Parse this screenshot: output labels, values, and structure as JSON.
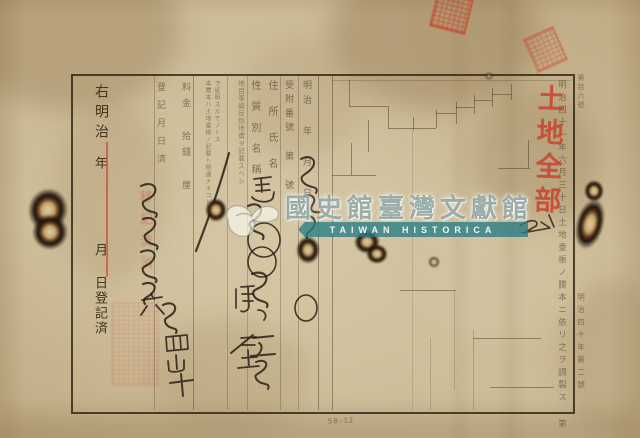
{
  "right_note": {
    "era": "右明治",
    "year": "年",
    "month": "月",
    "registered": "日登記済"
  },
  "register_columns": {
    "reg_date_cancel": "登記月日済",
    "fee": "料金 拾錢 厘",
    "fineprint_b1": "本謄本ハ土地臺帳ノ記載ト相違ナキコト",
    "fineprint_b2": "ヲ証明スルモノトス",
    "fineprint_a": "地目等級反別地價ヲ記載スヘシ",
    "type_name": "性質別名稱",
    "address_name": "住所氏名",
    "receipt_no": "受附番號 第 號",
    "date": "明治 年 月 日"
  },
  "side_notes": {
    "inner_right": "明治四十一年六月三十日土地臺帳ノ謄本ニ依リ之ヲ調製ス 第 號",
    "outer_top": "第拾六號",
    "outer_bottom": "明治四十年第二號"
  },
  "red_stamps": {
    "land_all": "土地全部",
    "cancel": "移記済消"
  },
  "handwriting": {
    "center_column": "馬",
    "signature": "陳星",
    "left_column": "號四山十"
  },
  "watermark": {
    "institution": "國史館臺灣文獻館",
    "banner": "TAIWAN HISTORICA"
  },
  "annotations": {
    "pencil": "58-12"
  },
  "colors": {
    "paper": "#cdbc98",
    "ink": "#231a10",
    "seal_red": "#cc3a28",
    "red_line": "#c63e28",
    "watermark_teal": "#287e87"
  }
}
